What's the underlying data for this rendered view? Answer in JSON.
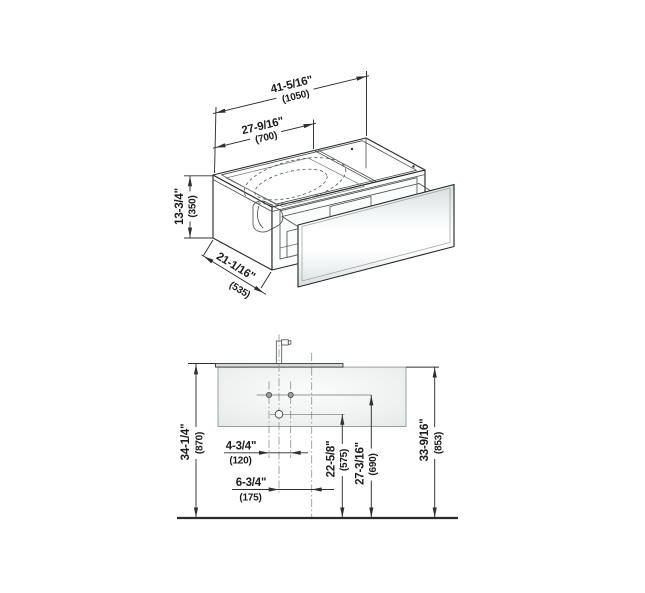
{
  "drawing": {
    "type": "vanity-unit-dimension-drawing",
    "views": [
      "isometric",
      "front-elevation"
    ]
  },
  "iso": {
    "width_total_in": "41-5/16\"",
    "width_total_mm": "(1050)",
    "basin_width_in": "27-9/16\"",
    "basin_width_mm": "(700)",
    "height_in": "13-3/4\"",
    "height_mm": "(350)",
    "depth_in": "21-1/16\"",
    "depth_mm": "(535)"
  },
  "front": {
    "height_left_in": "34-1/4\"",
    "height_left_mm": "(870)",
    "faucet_span_in": "4-3/4\"",
    "faucet_span_mm": "(120)",
    "drain_offset_in": "6-3/4\"",
    "drain_offset_mm": "(175)",
    "drain_height_in": "22-5/8\"",
    "drain_height_mm": "(575)",
    "faucet_height_in": "27-3/16\"",
    "faucet_height_mm": "(690)",
    "height_right_in": "33-9/16\"",
    "height_right_mm": "(853)"
  },
  "colors": {
    "line": "#2b2b2b",
    "centerline": "#8a9090",
    "cabinet_fill": "#e9ecec",
    "counter_fill": "#d6d9d9",
    "glass_glow": "#ffffff"
  }
}
